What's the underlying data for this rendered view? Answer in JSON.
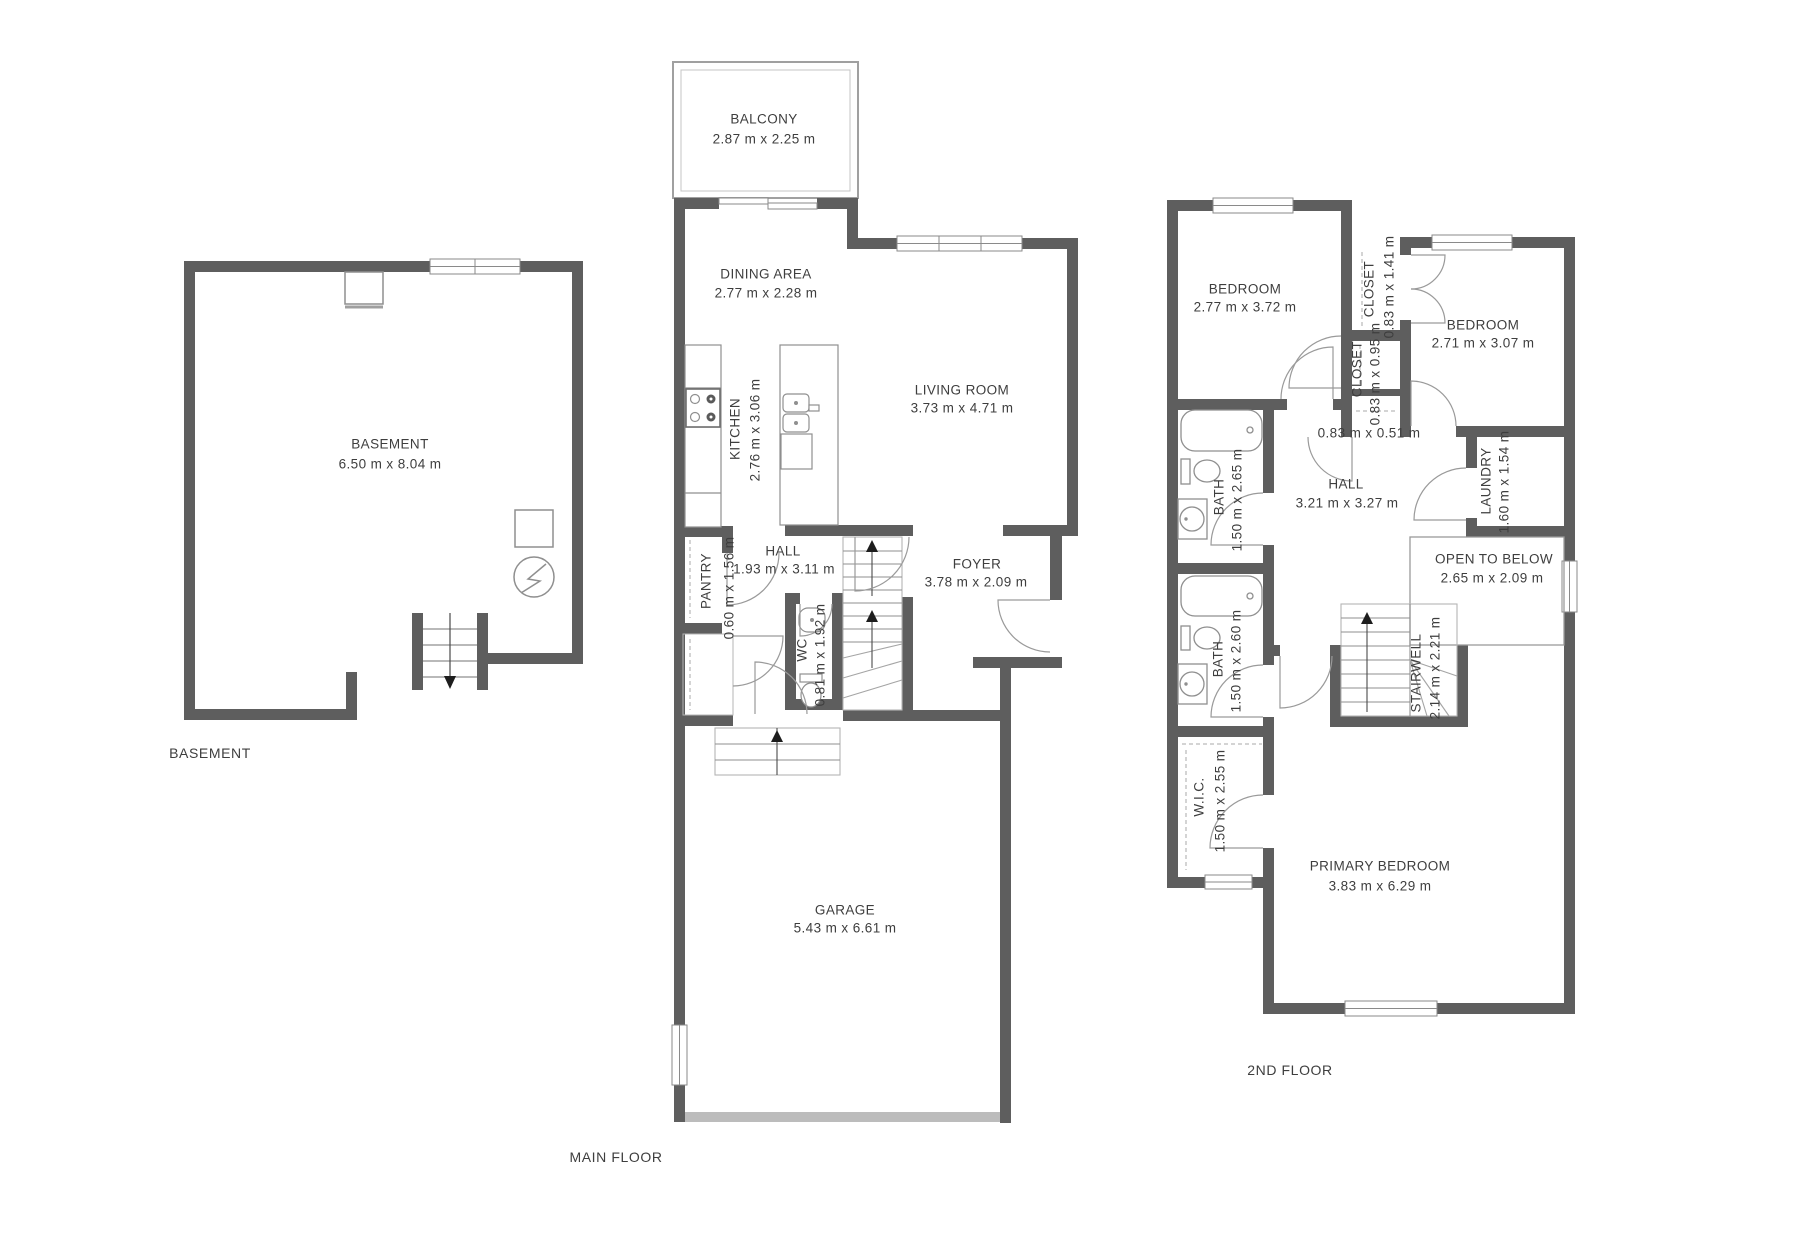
{
  "document": {
    "type": "residential floor pl an set",
    "background": "#ffffff"
  },
  "colors": {
    "wall": "#5e5e5e",
    "thin_line": "#9a9a9a",
    "text": "#3e3e3e",
    "garage_door": "#bcbcbc"
  },
  "floors": [
    {
      "label": "BASEMENT",
      "rooms": [
        {
          "name": "BASEMENT",
          "dims": "6.50 m x 8.04 m"
        }
      ]
    },
    {
      "label": "MAIN FLOOR",
      "rooms": [
        {
          "name": "BALCONY",
          "dims": "2.87 m x 2.25 m"
        },
        {
          "name": "DINING AREA",
          "dims": "2.77 m x 2.28 m"
        },
        {
          "name": "KITCHEN",
          "dims": "2.76 m x 3.06 m"
        },
        {
          "name": "LIVING ROOM",
          "dims": "3.73 m x 4.71 m"
        },
        {
          "name": "PANTRY",
          "dims": "0.60 m x 1.56 m"
        },
        {
          "name": "HALL",
          "dims": "1.93 m x 3.11 m"
        },
        {
          "name": "WC",
          "dims": "0.81 m x 1.92 m"
        },
        {
          "name": "FOYER",
          "dims": "3.78 m x 2.09 m"
        },
        {
          "name": "GARAGE",
          "dims": "5.43 m x 6.61 m"
        }
      ]
    },
    {
      "label": "2ND FLOOR",
      "rooms": [
        {
          "name": "BEDROOM",
          "dims": "2.77 m x 3.72 m"
        },
        {
          "name": "CLOSET",
          "dims": "0.83 m x 1.41 m"
        },
        {
          "name": "BEDROOM",
          "dims": "2.71 m x 3.07 m"
        },
        {
          "name": "CLOSET",
          "dims": "0.83 m x 0.95 m"
        },
        {
          "name": "",
          "dims": "0.83 m x 0.51 m"
        },
        {
          "name": "BATH",
          "dims": "1.50 m x 2.65 m"
        },
        {
          "name": "HALL",
          "dims": "3.21 m x 3.27 m"
        },
        {
          "name": "LAUNDRY",
          "dims": "1.60 m x 1.54 m"
        },
        {
          "name": "OPEN TO BELOW",
          "dims": "2.65 m x 2.09 m"
        },
        {
          "name": "BATH",
          "dims": "1.50 m x 2.60 m"
        },
        {
          "name": "STAIRWELL",
          "dims": "2.14 m x 2.21 m"
        },
        {
          "name": "W.I.C.",
          "dims": "1.50 m x 2.55 m"
        },
        {
          "name": "PRIMARY BEDROOM",
          "dims": "3.83 m x 6.29 m"
        }
      ]
    }
  ]
}
